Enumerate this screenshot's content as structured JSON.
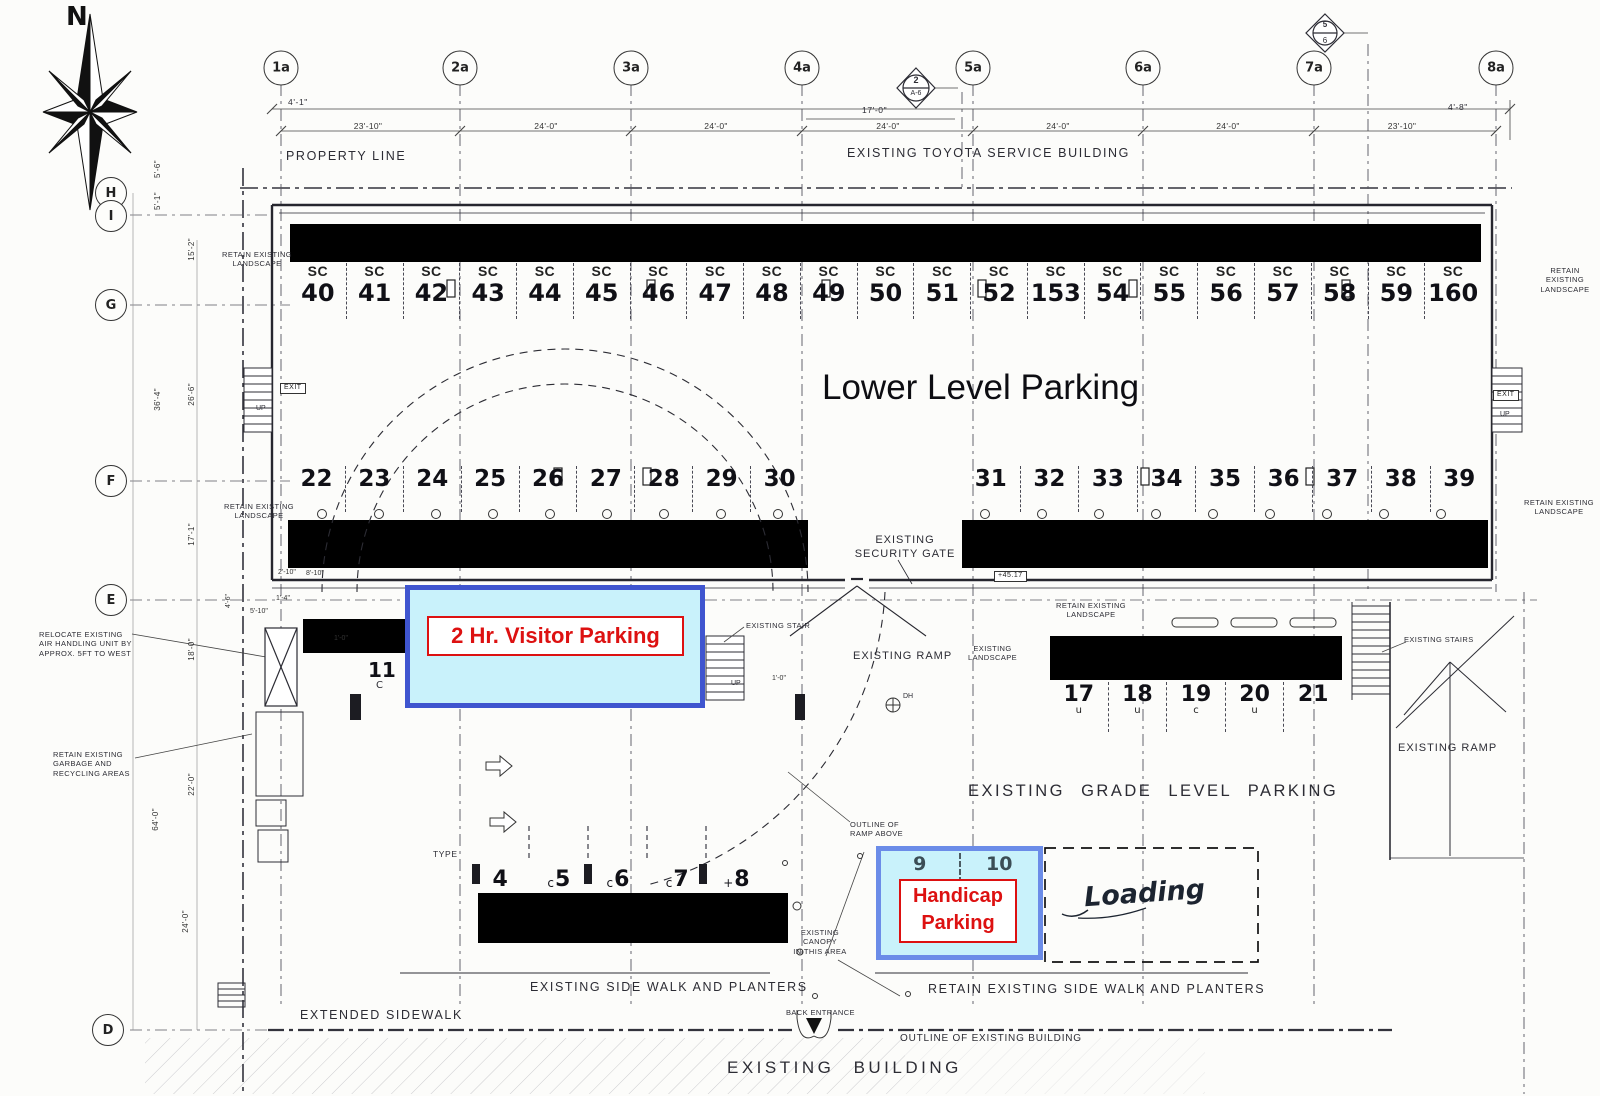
{
  "compass": {
    "label": "N"
  },
  "grid": {
    "columns": [
      "1a",
      "2a",
      "3a",
      "4a",
      "5a",
      "6a",
      "7a",
      "8a"
    ],
    "rows": [
      "H",
      "I",
      "G",
      "F",
      "E",
      "D"
    ]
  },
  "top_labels": {
    "property_line": "PROPERTY LINE",
    "toyota": "EXISTING TOYOTA SERVICE BUILDING"
  },
  "dims": {
    "d41": "4'-1\"",
    "d170": "17'-0\"",
    "d48": "4'-8\"",
    "top_row": [
      "23'-10\"",
      "24'-0\"",
      "24'-0\"",
      "24'-0\"",
      "24'-0\"",
      "24'-0\"",
      "23'-10\""
    ],
    "left": [
      "5'-6\"",
      "5'-1\"",
      "15'-2\"",
      "36'-4\"",
      "26'-6\"",
      "17'-1\"",
      "18'-0\"",
      "22'-0\"",
      "64'-0\"",
      "24'-0\""
    ],
    "small": [
      "2'-10\"",
      "8'-10\"",
      "4'-6\"",
      "5'-10\"",
      "1'-4\"",
      "1'-0\"",
      "1'-0\""
    ]
  },
  "detail_markers": {
    "m1_top": "2",
    "m1_bottom": "A-6",
    "m2_top": "5",
    "m2_bottom": "6"
  },
  "parking": {
    "lower_title": "Lower Level Parking",
    "row_top": [
      {
        "sc": "SC",
        "n": "40"
      },
      {
        "sc": "SC",
        "n": "41"
      },
      {
        "sc": "SC",
        "n": "42"
      },
      {
        "sc": "SC",
        "n": "43"
      },
      {
        "sc": "SC",
        "n": "44"
      },
      {
        "sc": "SC",
        "n": "45"
      },
      {
        "sc": "SC",
        "n": "46"
      },
      {
        "sc": "SC",
        "n": "47"
      },
      {
        "sc": "SC",
        "n": "48"
      },
      {
        "sc": "SC",
        "n": "49"
      },
      {
        "sc": "SC",
        "n": "50"
      },
      {
        "sc": "SC",
        "n": "51"
      },
      {
        "sc": "SC",
        "n": "52"
      },
      {
        "sc": "SC",
        "n": "153"
      },
      {
        "sc": "SC",
        "n": "54"
      },
      {
        "sc": "SC",
        "n": "55"
      },
      {
        "sc": "SC",
        "n": "56"
      },
      {
        "sc": "SC",
        "n": "57"
      },
      {
        "sc": "SC",
        "n": "58"
      },
      {
        "sc": "SC",
        "n": "59"
      },
      {
        "sc": "SC",
        "n": "160"
      }
    ],
    "row_mid_left": [
      "22",
      "23",
      "24",
      "25",
      "26",
      "27",
      "28",
      "29",
      "30"
    ],
    "row_mid_right": [
      "31",
      "32",
      "33",
      "34",
      "35",
      "36",
      "37",
      "38",
      "39"
    ],
    "row_grade": [
      {
        "n": "17",
        "s": "u"
      },
      {
        "n": "18",
        "s": "u"
      },
      {
        "n": "19",
        "s": "c"
      },
      {
        "n": "20",
        "s": "u"
      },
      {
        "n": "21",
        "s": ""
      }
    ],
    "row_bottom": [
      {
        "p": "",
        "n": "4"
      },
      {
        "p": "c",
        "n": "5"
      },
      {
        "p": "c",
        "n": "6"
      },
      {
        "p": "c",
        "n": "7"
      },
      {
        "p": "+",
        "n": "8"
      }
    ],
    "handicap_stalls": [
      "9",
      "10"
    ],
    "stall11": {
      "n": "11",
      "s": "C"
    }
  },
  "boxes": {
    "visitor_label": "2 Hr. Visitor Parking",
    "handicap_line1": "Handicap",
    "handicap_line2": "Parking",
    "colors": {
      "fill": "#c9f2fb",
      "visitor_border": "#3f55cf",
      "handicap_border": "#6b8ce8",
      "red": "#dd1111"
    }
  },
  "annotations": {
    "security_gate": "EXISTING\nSECURITY GATE",
    "ramp_center": "EXISTING RAMP",
    "ramp_right": "EXISTING RAMP",
    "stairs_right": "EXISTING STAIRS",
    "stair_center": "EXISTING STAIR",
    "grade_parking": "EXISTING GRADE LEVEL PARKING",
    "relocate": "RELOCATE EXISTING\nAIR HANDLING UNIT BY\nAPPROX. 5FT TO WEST",
    "garbage": "RETAIN EXISTING\nGARBAGE AND\nRECYCLING AREAS",
    "retain_landscape": "RETAIN EXISTING\nLANDSCAPE",
    "existing_landscape": "EXISTING\nLANDSCAPE",
    "outline_ramp": "OUTLINE OF\nRAMP ABOVE",
    "canopy": "EXISTING CANOPY\nIN THIS AREA",
    "type_label": "TYPE",
    "sidewalk_planters": "EXISTING SIDE WALK AND PLANTERS",
    "retain_sidewalk": "RETAIN EXISTING SIDE WALK AND PLANTERS",
    "extended_sidewalk": "EXTENDED SIDEWALK",
    "back_entrance": "BACK ENTRANCE",
    "outline_building": "OUTLINE OF EXISTING BUILDING",
    "existing_building": "EXISTING BUILDING",
    "loading": "Loading",
    "exit": "EXIT",
    "up": "UP",
    "elev": "+45.17",
    "dh": "DH"
  }
}
